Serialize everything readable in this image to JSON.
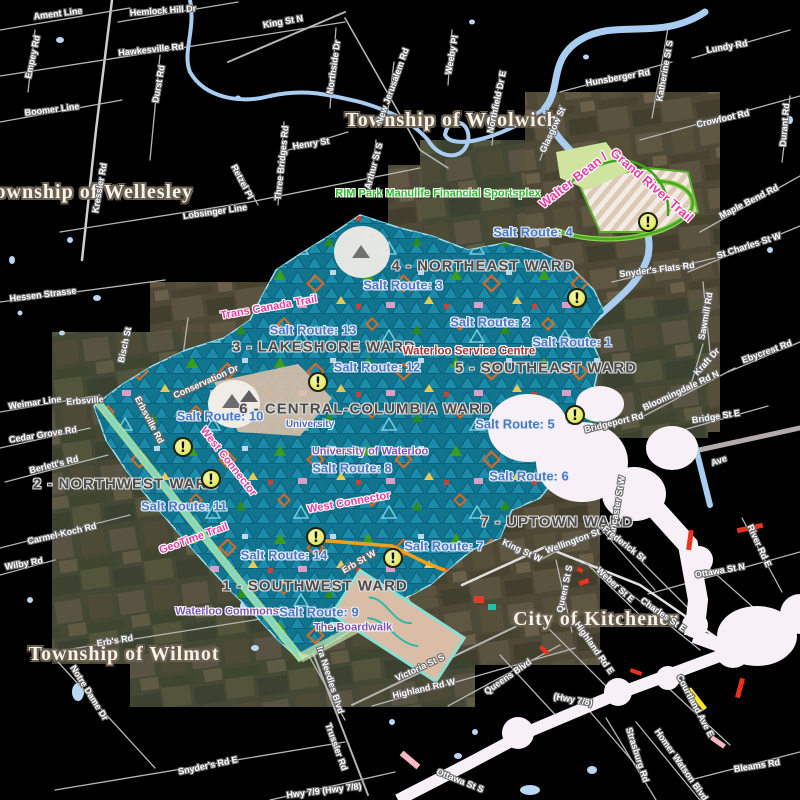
{
  "map": {
    "title": "City of Waterloo wards and salt routes map",
    "warning_glyph": "!",
    "colors": {
      "background": "#000000",
      "city_symbols_teal": "#1b8cab",
      "salt_route_text": "#4b79c5",
      "ward_text": "#4c4c4c",
      "municipality_text": "#f8f3e8",
      "street_text": "#ffffff",
      "trail_text": "#e93aa2",
      "poi_green": "#2dbb2d",
      "poi_purple": "#7b52b8",
      "poi_red": "#a23337",
      "poi_blue": "#4d68c8",
      "warning_fill": "#edf17c",
      "road": "#bdbdbd",
      "water": "#a8cdf1",
      "floodplain_white": "#f7f0f6"
    },
    "municipality_labels": [
      {
        "text": "Township of Woolwich",
        "x": 452,
        "y": 120,
        "rot": 0
      },
      {
        "text": "Township of Wellesley",
        "x": 88,
        "y": 192,
        "rot": 0
      },
      {
        "text": "Township of Wilmot",
        "x": 124,
        "y": 654,
        "rot": 0
      },
      {
        "text": "City of Kitchener",
        "x": 596,
        "y": 619,
        "rot": 0
      }
    ],
    "ward_labels": [
      {
        "text": "4 - NORTHEAST WARD",
        "x": 483,
        "y": 266,
        "rot": 0
      },
      {
        "text": "3 - LAKESHORE WARD",
        "x": 324,
        "y": 347,
        "rot": 0
      },
      {
        "text": "5 - SOUTHEAST WARD",
        "x": 546,
        "y": 368,
        "rot": 0
      },
      {
        "text": "6 - CENTRAL-COLUMBIA WARD",
        "x": 366,
        "y": 409,
        "rot": 0
      },
      {
        "text": "2 - NORTHWEST WARD",
        "x": 126,
        "y": 484,
        "rot": 0
      },
      {
        "text": "7 - UPTOWN WARD",
        "x": 557,
        "y": 522,
        "rot": 0
      },
      {
        "text": "1 - SOUTHWEST WARD",
        "x": 315,
        "y": 586,
        "rot": 0
      }
    ],
    "salt_route_labels": [
      {
        "text": "Salt Route: 4",
        "x": 533,
        "y": 232,
        "rot": 0
      },
      {
        "text": "Salt Route: 3",
        "x": 403,
        "y": 285,
        "rot": 0
      },
      {
        "text": "Salt Route: 2",
        "x": 490,
        "y": 322,
        "rot": 0
      },
      {
        "text": "Salt Route: 1",
        "x": 572,
        "y": 342,
        "rot": 0
      },
      {
        "text": "Salt Route: 13",
        "x": 313,
        "y": 330,
        "rot": 0
      },
      {
        "text": "Salt Route: 12",
        "x": 377,
        "y": 367,
        "rot": 0
      },
      {
        "text": "Salt Route: 10",
        "x": 220,
        "y": 416,
        "rot": 0
      },
      {
        "text": "Salt Route: 5",
        "x": 515,
        "y": 424,
        "rot": 0
      },
      {
        "text": "Salt Route: 8",
        "x": 352,
        "y": 468,
        "rot": 0
      },
      {
        "text": "Salt Route: 6",
        "x": 529,
        "y": 476,
        "rot": 0
      },
      {
        "text": "Salt Route: 11",
        "x": 184,
        "y": 506,
        "rot": 0
      },
      {
        "text": "Salt Route: 7",
        "x": 444,
        "y": 546,
        "rot": 0
      },
      {
        "text": "Salt Route: 14",
        "x": 284,
        "y": 555,
        "rot": 0
      },
      {
        "text": "Salt Route: 9",
        "x": 319,
        "y": 612,
        "rot": 0
      }
    ],
    "poi_labels": [
      {
        "text": "RIM Park Manulife Financial Sportsplex",
        "x": 438,
        "y": 194,
        "rot": 0,
        "style": "green"
      },
      {
        "text": "Waterloo Service Centre",
        "x": 469,
        "y": 352,
        "rot": 0,
        "style": "red"
      },
      {
        "text": "University of Waterloo",
        "x": 370,
        "y": 452,
        "rot": 0,
        "style": "purple"
      },
      {
        "text": "University",
        "x": 310,
        "y": 425,
        "rot": 0,
        "style": "blue"
      },
      {
        "text": "Waterloo Commons",
        "x": 227,
        "y": 612,
        "rot": 0,
        "style": "purple"
      },
      {
        "text": "The Boardwalk",
        "x": 353,
        "y": 628,
        "rot": 0,
        "style": "purple"
      }
    ],
    "trail_labels": [
      {
        "text": "Walter Bean /",
        "x": 573,
        "y": 180,
        "rot": -38,
        "large": true
      },
      {
        "text": "Grand River Trail",
        "x": 652,
        "y": 185,
        "rot": 41,
        "large": true
      },
      {
        "text": "Trans Canada Trail",
        "x": 269,
        "y": 308,
        "rot": -10,
        "large": false
      },
      {
        "text": "West Connector",
        "x": 228,
        "y": 462,
        "rot": 52,
        "large": false
      },
      {
        "text": "West Connector",
        "x": 349,
        "y": 503,
        "rot": -10,
        "large": false
      },
      {
        "text": "GeoTime Trail",
        "x": 194,
        "y": 539,
        "rot": -20,
        "large": false
      }
    ],
    "street_labels": [
      {
        "text": "Ament Line",
        "x": 58,
        "y": 14,
        "rot": -7
      },
      {
        "text": "Hemlock Hill Dr",
        "x": 163,
        "y": 11,
        "rot": -4
      },
      {
        "text": "King St N",
        "x": 283,
        "y": 22,
        "rot": -10
      },
      {
        "text": "Hawkesville Rd",
        "x": 151,
        "y": 50,
        "rot": -6
      },
      {
        "text": "Empey Rd",
        "x": 33,
        "y": 57,
        "rot": -78
      },
      {
        "text": "Durst Rd",
        "x": 159,
        "y": 84,
        "rot": -80
      },
      {
        "text": "Boomer Line",
        "x": 52,
        "y": 110,
        "rot": -7
      },
      {
        "text": "Northside Dr",
        "x": 334,
        "y": 67,
        "rot": -82
      },
      {
        "text": "Henry St",
        "x": 311,
        "y": 144,
        "rot": -9
      },
      {
        "text": "Retzel Pl",
        "x": 242,
        "y": 182,
        "rot": 62
      },
      {
        "text": "Three Bridges Rd",
        "x": 282,
        "y": 163,
        "rot": -84
      },
      {
        "text": "New Jerusalem Rd",
        "x": 393,
        "y": 86,
        "rot": -70
      },
      {
        "text": "Arthur St S",
        "x": 374,
        "y": 166,
        "rot": -75
      },
      {
        "text": "Hessen Strasse",
        "x": 43,
        "y": 295,
        "rot": -7
      },
      {
        "text": "Kressler Rd",
        "x": 100,
        "y": 188,
        "rot": -80
      },
      {
        "text": "Bisch St",
        "x": 125,
        "y": 345,
        "rot": -78
      },
      {
        "text": "Lobsinger Line",
        "x": 215,
        "y": 212,
        "rot": -8
      },
      {
        "text": "Weeby Pl",
        "x": 452,
        "y": 55,
        "rot": -80
      },
      {
        "text": "Northfield Dr E",
        "x": 497,
        "y": 102,
        "rot": -78
      },
      {
        "text": "Glasgow St",
        "x": 553,
        "y": 130,
        "rot": -65
      },
      {
        "text": "Hunsberger Rd",
        "x": 618,
        "y": 78,
        "rot": -10
      },
      {
        "text": "Katherine St S",
        "x": 665,
        "y": 71,
        "rot": -80
      },
      {
        "text": "Lundy Rd",
        "x": 727,
        "y": 47,
        "rot": -10
      },
      {
        "text": "Crowfoot Rd",
        "x": 723,
        "y": 119,
        "rot": -13
      },
      {
        "text": "Durant Rd",
        "x": 785,
        "y": 125,
        "rot": -85
      },
      {
        "text": "Maple Bend Rd",
        "x": 749,
        "y": 202,
        "rot": -27
      },
      {
        "text": "St Charles St W",
        "x": 749,
        "y": 246,
        "rot": -18
      },
      {
        "text": "Snyder's Flats Rd",
        "x": 657,
        "y": 270,
        "rot": -7
      },
      {
        "text": "Sawmill Rd",
        "x": 706,
        "y": 316,
        "rot": -80
      },
      {
        "text": "Ebycrest Rd",
        "x": 767,
        "y": 352,
        "rot": -20
      },
      {
        "text": "Kraft Dr",
        "x": 707,
        "y": 362,
        "rot": -48
      },
      {
        "text": "Bloomingdale Rd N",
        "x": 681,
        "y": 391,
        "rot": -25
      },
      {
        "text": "Bridge St E",
        "x": 716,
        "y": 417,
        "rot": -9
      },
      {
        "text": "Bridgeport Rd",
        "x": 614,
        "y": 423,
        "rot": -14
      },
      {
        "text": "Ave",
        "x": 719,
        "y": 461,
        "rot": -20
      },
      {
        "text": "Lancaster St W",
        "x": 617,
        "y": 508,
        "rot": -80
      },
      {
        "text": "King St W",
        "x": 522,
        "y": 551,
        "rot": 25
      },
      {
        "text": "Wellington St N",
        "x": 577,
        "y": 540,
        "rot": -20
      },
      {
        "text": "Frederick St",
        "x": 624,
        "y": 544,
        "rot": 38
      },
      {
        "text": "Queen St S",
        "x": 565,
        "y": 589,
        "rot": -78
      },
      {
        "text": "Weber St E",
        "x": 615,
        "y": 585,
        "rot": 42
      },
      {
        "text": "Charles St E",
        "x": 663,
        "y": 615,
        "rot": 35
      },
      {
        "text": "Ottawa St N",
        "x": 720,
        "y": 571,
        "rot": -10
      },
      {
        "text": "River Rd E",
        "x": 759,
        "y": 546,
        "rot": 65
      },
      {
        "text": "Victoria St S",
        "x": 420,
        "y": 668,
        "rot": -25
      },
      {
        "text": "Highland Rd W",
        "x": 424,
        "y": 689,
        "rot": -13
      },
      {
        "text": "Queens Blvd",
        "x": 508,
        "y": 677,
        "rot": -35
      },
      {
        "text": "Highland Rd E",
        "x": 594,
        "y": 648,
        "rot": 55
      },
      {
        "text": "(Hwy 7/8)",
        "x": 573,
        "y": 700,
        "rot": 10
      },
      {
        "text": "Courtland Ave E",
        "x": 695,
        "y": 706,
        "rot": 62
      },
      {
        "text": "Homer Watson Blvd",
        "x": 681,
        "y": 765,
        "rot": 55
      },
      {
        "text": "Strasburg Rd",
        "x": 637,
        "y": 755,
        "rot": 72
      },
      {
        "text": "Ottawa St S",
        "x": 460,
        "y": 781,
        "rot": 22
      },
      {
        "text": "Bleams Rd",
        "x": 757,
        "y": 766,
        "rot": -9
      },
      {
        "text": "Hwy 7/9 (Hwy 7/8)",
        "x": 324,
        "y": 791,
        "rot": -7
      },
      {
        "text": "Erb's Rd",
        "x": 115,
        "y": 641,
        "rot": -9
      },
      {
        "text": "Notre Dame Dr",
        "x": 89,
        "y": 693,
        "rot": 58
      },
      {
        "text": "Snyder's Rd E",
        "x": 208,
        "y": 766,
        "rot": -12
      },
      {
        "text": "Ira Needles Blvd",
        "x": 330,
        "y": 680,
        "rot": 72
      },
      {
        "text": "Trussler Rd",
        "x": 336,
        "y": 747,
        "rot": 70
      },
      {
        "text": "Erb St W",
        "x": 359,
        "y": 562,
        "rot": -30
      },
      {
        "text": "Conservation Dr",
        "x": 206,
        "y": 382,
        "rot": -24
      },
      {
        "text": "Erbsville Rd",
        "x": 149,
        "y": 420,
        "rot": 62
      },
      {
        "text": "Weimar Line",
        "x": 35,
        "y": 403,
        "rot": -8
      },
      {
        "text": "Erbsville",
        "x": 85,
        "y": 401,
        "rot": -4
      },
      {
        "text": "Cedar Grove Rd",
        "x": 43,
        "y": 435,
        "rot": -9
      },
      {
        "text": "Berlett's Rd",
        "x": 54,
        "y": 465,
        "rot": -14
      },
      {
        "text": "Carmel-Koch Rd",
        "x": 62,
        "y": 534,
        "rot": -13
      },
      {
        "text": "Wilby Rd",
        "x": 24,
        "y": 564,
        "rot": -10
      }
    ],
    "warning_icons": [
      {
        "x": 648,
        "y": 222
      },
      {
        "x": 577,
        "y": 298
      },
      {
        "x": 318,
        "y": 382
      },
      {
        "x": 575,
        "y": 415
      },
      {
        "x": 183,
        "y": 447
      },
      {
        "x": 211,
        "y": 479
      },
      {
        "x": 316,
        "y": 537
      },
      {
        "x": 393,
        "y": 558
      }
    ]
  }
}
